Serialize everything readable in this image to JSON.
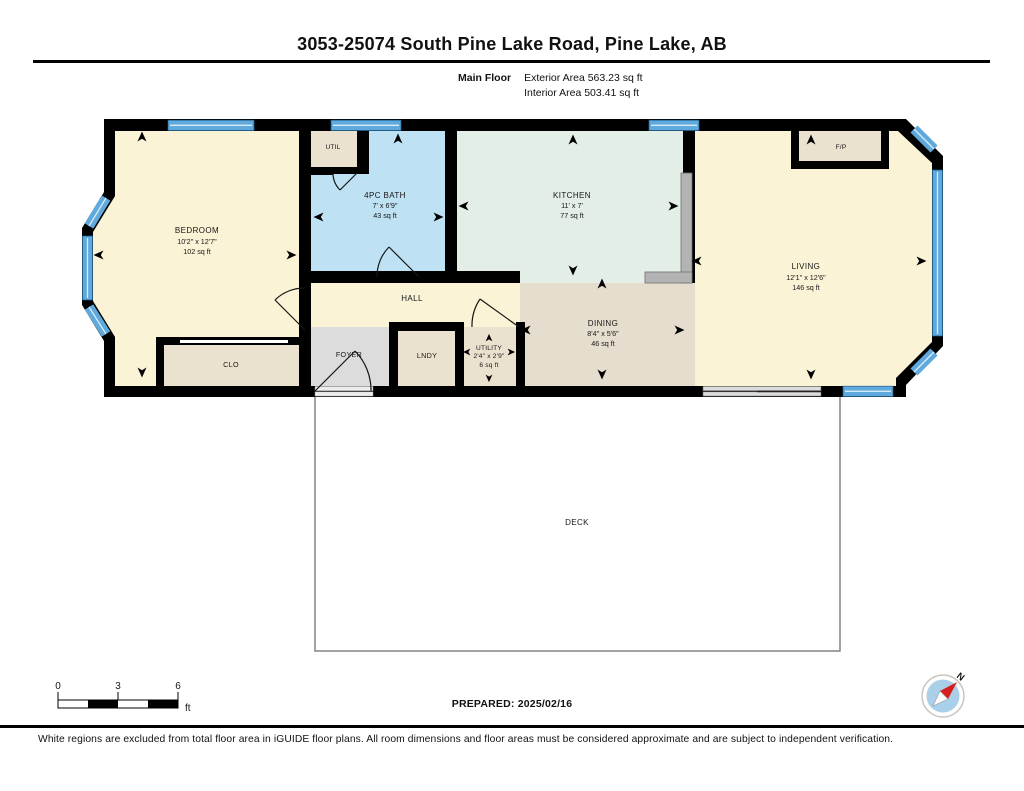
{
  "header": {
    "title": "3053-25074 South Pine Lake Road, Pine Lake, AB",
    "floor_label": "Main Floor",
    "exterior_area": "Exterior Area 563.23 sq ft",
    "interior_area": "Interior Area 503.41 sq ft"
  },
  "plan": {
    "rooms": [
      {
        "name": "BEDROOM",
        "dims": "10'2\" x 12'7\"",
        "area": "102 sq ft"
      },
      {
        "name": "4PC BATH",
        "dims": "7' x 6'9\"",
        "area": "43 sq ft"
      },
      {
        "name": "KITCHEN",
        "dims": "11' x 7'",
        "area": "77 sq ft"
      },
      {
        "name": "LIVING",
        "dims": "12'1\" x 12'6\"",
        "area": "146 sq ft"
      },
      {
        "name": "DINING",
        "dims": "8'4\" x 5'6\"",
        "area": "46 sq ft"
      },
      {
        "name": "UTILITY",
        "dims": "2'4\" x 2'9\"",
        "area": "6 sq ft"
      }
    ],
    "labels": {
      "hall": "HALL",
      "foyer": "FOYER",
      "lndy": "LNDY",
      "clo": "CLO",
      "util": "UTIL",
      "fireplace": "F/P",
      "deck": "DECK"
    }
  },
  "scale_bar": {
    "tick0": "0",
    "tick3": "3",
    "tick6": "6",
    "unit": "ft"
  },
  "compass": {
    "north": "N"
  },
  "footer": {
    "prepared": "PREPARED: 2025/02/16",
    "disclaimer": "White regions are excluded from total floor area in iGUIDE floor plans. All room dimensions and floor areas must be considered approximate and are subject to independent verification."
  },
  "colors": {
    "room_cream": "#faf3d6",
    "bath_blue": "#bfe1f4",
    "kitchen_teal": "#e2eee6",
    "dining_beige": "#e5ddcd",
    "closet_tan": "#eae1cf",
    "foyer_gray": "#dcdcdc",
    "window_blue": "#5fa9dc",
    "wall_black": "#000000"
  }
}
